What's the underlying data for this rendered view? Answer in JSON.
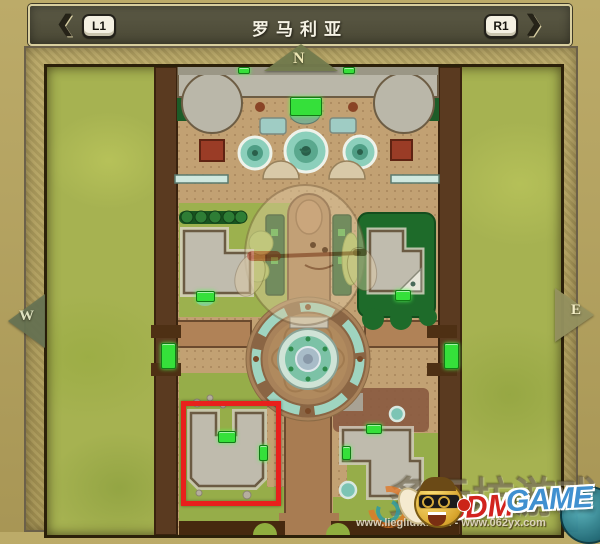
{
  "title_bar": {
    "title": "罗马利亚",
    "left_shoulder": "L1",
    "right_shoulder": "R1"
  },
  "icons": {
    "prev_arrow": "❮",
    "next_arrow": "❯"
  },
  "compass": {
    "north": "N",
    "west": "W",
    "east": "E"
  },
  "map": {
    "name": "罗马利亚",
    "highlight": {
      "x": 134,
      "y": 334,
      "w": 90,
      "h": 95
    },
    "door_markers": [
      {
        "x": 243,
        "y": 30,
        "w": 30,
        "h": 17
      },
      {
        "x": 191,
        "y": 0,
        "w": 10,
        "h": 5
      },
      {
        "x": 296,
        "y": 0,
        "w": 10,
        "h": 5
      },
      {
        "x": 149,
        "y": 224,
        "w": 17,
        "h": 9
      },
      {
        "x": 348,
        "y": 223,
        "w": 14,
        "h": 9
      },
      {
        "x": 114,
        "y": 276,
        "w": 13,
        "h": 24
      },
      {
        "x": 397,
        "y": 276,
        "w": 13,
        "h": 24
      },
      {
        "x": 171,
        "y": 364,
        "w": 16,
        "h": 10
      },
      {
        "x": 212,
        "y": 378,
        "w": 7,
        "h": 14
      },
      {
        "x": 319,
        "y": 357,
        "w": 14,
        "h": 8
      },
      {
        "x": 295,
        "y": 379,
        "w": 7,
        "h": 12
      }
    ]
  },
  "watermark": {
    "cn_text": "多元坊游戏",
    "brand_red": "3DM",
    "brand_blue": "GAME",
    "urls": "www.liegliufx.com - www.062yx.com"
  },
  "colors": {
    "door-green": "#35e03a",
    "highlight-red": "#e8201c",
    "grass": "#a6b251",
    "ground": "#c2a173",
    "wall": "#5a3a20",
    "lawn-dark": "#1e6b2a",
    "water": "#8ccfbb",
    "stone": "#bfbbad"
  }
}
